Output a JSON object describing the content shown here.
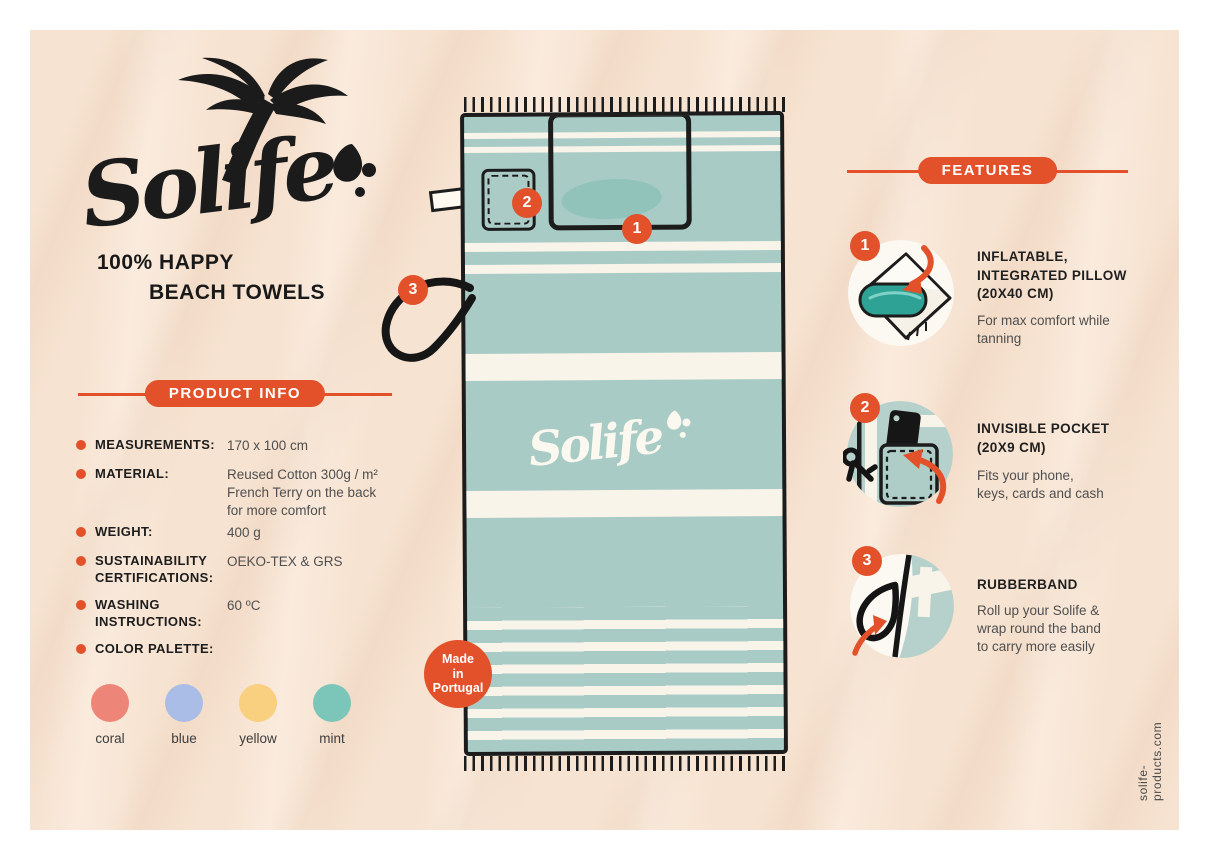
{
  "colors": {
    "accent": "#e3512b",
    "sand": "#f7e3d1",
    "towel_teal": "#a9cbc6",
    "stripe_cream": "#f8f4ea",
    "ink": "#1c1c1c"
  },
  "brand": {
    "logo_text": "Solife",
    "tagline_line1": "100% HAPPY",
    "tagline_line2": "BEACH TOWELS",
    "website": "solife-products.com"
  },
  "product_info": {
    "header": "PRODUCT INFO",
    "rows": [
      {
        "label": "MEASUREMENTS:",
        "value": "170 x 100 cm"
      },
      {
        "label": "MATERIAL:",
        "value": "Reused Cotton 300g / m²\nFrench Terry on the back\nfor more comfort"
      },
      {
        "label": "WEIGHT:",
        "value": "400 g"
      },
      {
        "label": "SUSTAINABILITY CERTIFICATIONS:",
        "value": "OEKO-TEX & GRS"
      },
      {
        "label": "WASHING INSTRUCTIONS:",
        "value": "60 ºC"
      },
      {
        "label": "COLOR PALETTE:",
        "value": ""
      }
    ],
    "palette": [
      {
        "name": "coral",
        "color": "#ed8678"
      },
      {
        "name": "blue",
        "color": "#aabde6"
      },
      {
        "name": "yellow",
        "color": "#f9cf80"
      },
      {
        "name": "mint",
        "color": "#7cc6b9"
      }
    ]
  },
  "features": {
    "header": "FEATURES",
    "items": [
      {
        "number": "1",
        "title": "INFLATABLE,\nINTEGRATED PILLOW\n(20X40 CM)",
        "description": "For max comfort while\ntanning"
      },
      {
        "number": "2",
        "title": "INVISIBLE POCKET\n(20X9 CM)",
        "description": "Fits your phone,\nkeys, cards and cash"
      },
      {
        "number": "3",
        "title": "RUBBERBAND",
        "description": "Roll up your Solife &\nwrap round the band\nto carry more easily"
      }
    ]
  },
  "towel": {
    "logo_text": "Solife",
    "badge_pillow": "1",
    "badge_pocket": "2",
    "badge_band": "3",
    "made_in": {
      "line1": "Made",
      "line2": "in",
      "line3": "Portugal"
    }
  }
}
